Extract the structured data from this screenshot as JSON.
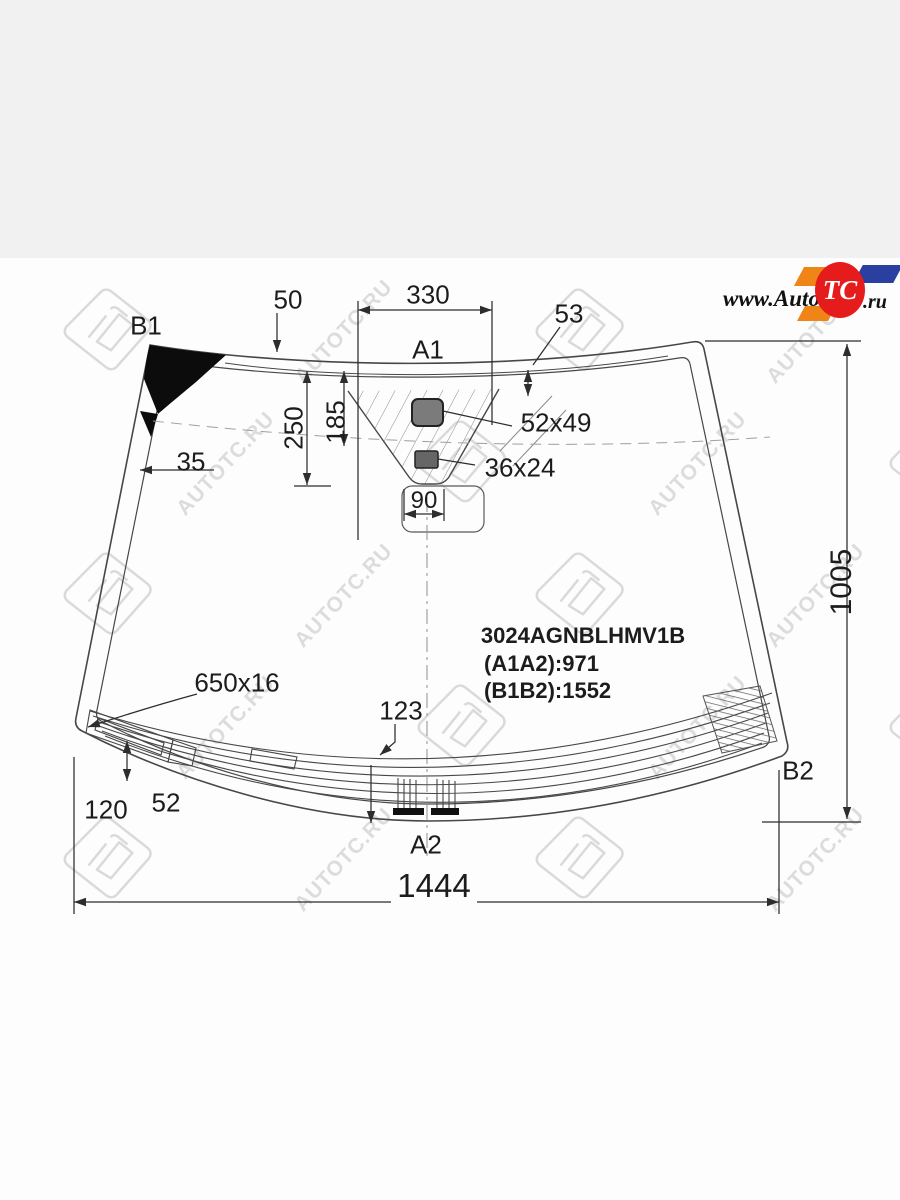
{
  "page": {
    "background": "#fdfdfd",
    "top_band_color": "#f1f1f2",
    "line_color": "#474747"
  },
  "logo": {
    "left": "www.Auto",
    "tc": "TC",
    "right": ".ru",
    "red": "#e61c1c",
    "orange": "#ef8417",
    "blue": "#2a3f9f"
  },
  "watermark": {
    "text": "AUTOTC.RU"
  },
  "diagram": {
    "corner_labels": {
      "b1": "B1",
      "a1": "A1",
      "a2": "A2",
      "b2": "B2"
    },
    "part": {
      "number": "3024AGNBLHMV1B",
      "a1a2": "(A1A2):971",
      "b1b2": "(B1B2):1552"
    },
    "dimensions": {
      "d50": "50",
      "d330": "330",
      "d53": "53",
      "d250": "250",
      "d185": "185",
      "sensor_large": "52x49",
      "sensor_small": "36x24",
      "d90": "90",
      "d35": "35",
      "d1005": "1005",
      "heater": "650x16",
      "d123": "123",
      "d120": "120",
      "d52": "52",
      "d1444": "1444"
    }
  }
}
